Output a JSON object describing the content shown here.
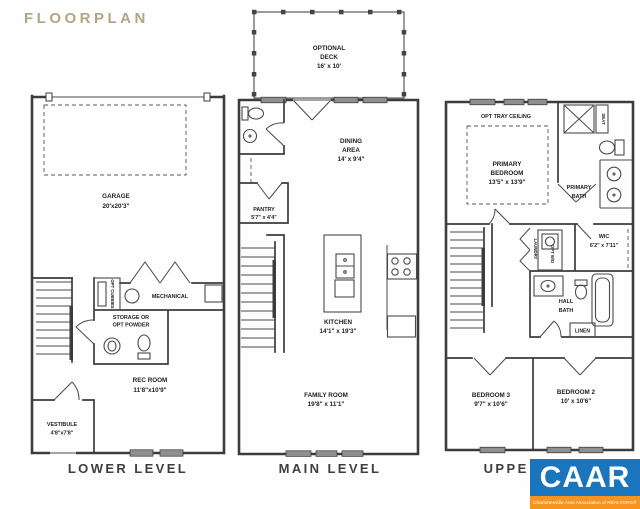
{
  "title": "FLOORPLAN",
  "plans": {
    "lower": {
      "label": "LOWER LEVEL",
      "garage_name": "GARAGE",
      "garage_dims": "20'x20'3\"",
      "cubbies": "OPT CUBBIES",
      "mechanical": "MECHANICAL",
      "storage_line1": "STORAGE OR",
      "storage_line2": "OPT POWDER",
      "rec_name": "REC ROOM",
      "rec_dims": "11'8\"x10'9\"",
      "vestibule_name": "VESTIBULE",
      "vestibule_dims": "4'8\"x7'8\""
    },
    "main": {
      "label": "MAIN LEVEL",
      "deck_line1": "OPTIONAL",
      "deck_line2": "DECK",
      "deck_dims": "16' x 10'",
      "dining_line1": "DINING",
      "dining_line2": "AREA",
      "dining_dims": "14' x 9'4\"",
      "pantry_name": "PANTRY",
      "pantry_dims": "5'7\" x 4'4\"",
      "kitchen_name": "KITCHEN",
      "kitchen_dims": "14'1\" x 19'3\"",
      "family_name": "FAMILY ROOM",
      "family_dims": "19'8\" x 11'1\""
    },
    "upper": {
      "label": "UPPER LEVEL",
      "tray": "OPT TRAY CEILING",
      "primary_line1": "PRIMARY",
      "primary_line2": "BEDROOM",
      "primary_dims": "13'5\" x 13'9\"",
      "seat": "SEAT",
      "pbath_line1": "PRIMARY",
      "pbath_line2": "BATH",
      "laundry": "LAUNDRY",
      "opt_wd": "OPT W/D",
      "wic_name": "WIC",
      "wic_dims": "6'2\" x 7'11\"",
      "hallbath_line1": "HALL",
      "hallbath_line2": "BATH",
      "linen": "LINEN",
      "bed3_name": "BEDROOM 3",
      "bed3_dims": "9'7\" x 10'6\"",
      "bed2_name": "BEDROOM 2",
      "bed2_dims": "10' x 10'6\""
    }
  },
  "logo": {
    "text": "CAAR",
    "tagline": "Charlottesville Area Association of REALTORS®"
  },
  "colors": {
    "title_accent": "#b3a486",
    "wall_ink": "#3c3c3c",
    "logo_blue": "#1b75bc",
    "logo_orange": "#f7941e"
  }
}
